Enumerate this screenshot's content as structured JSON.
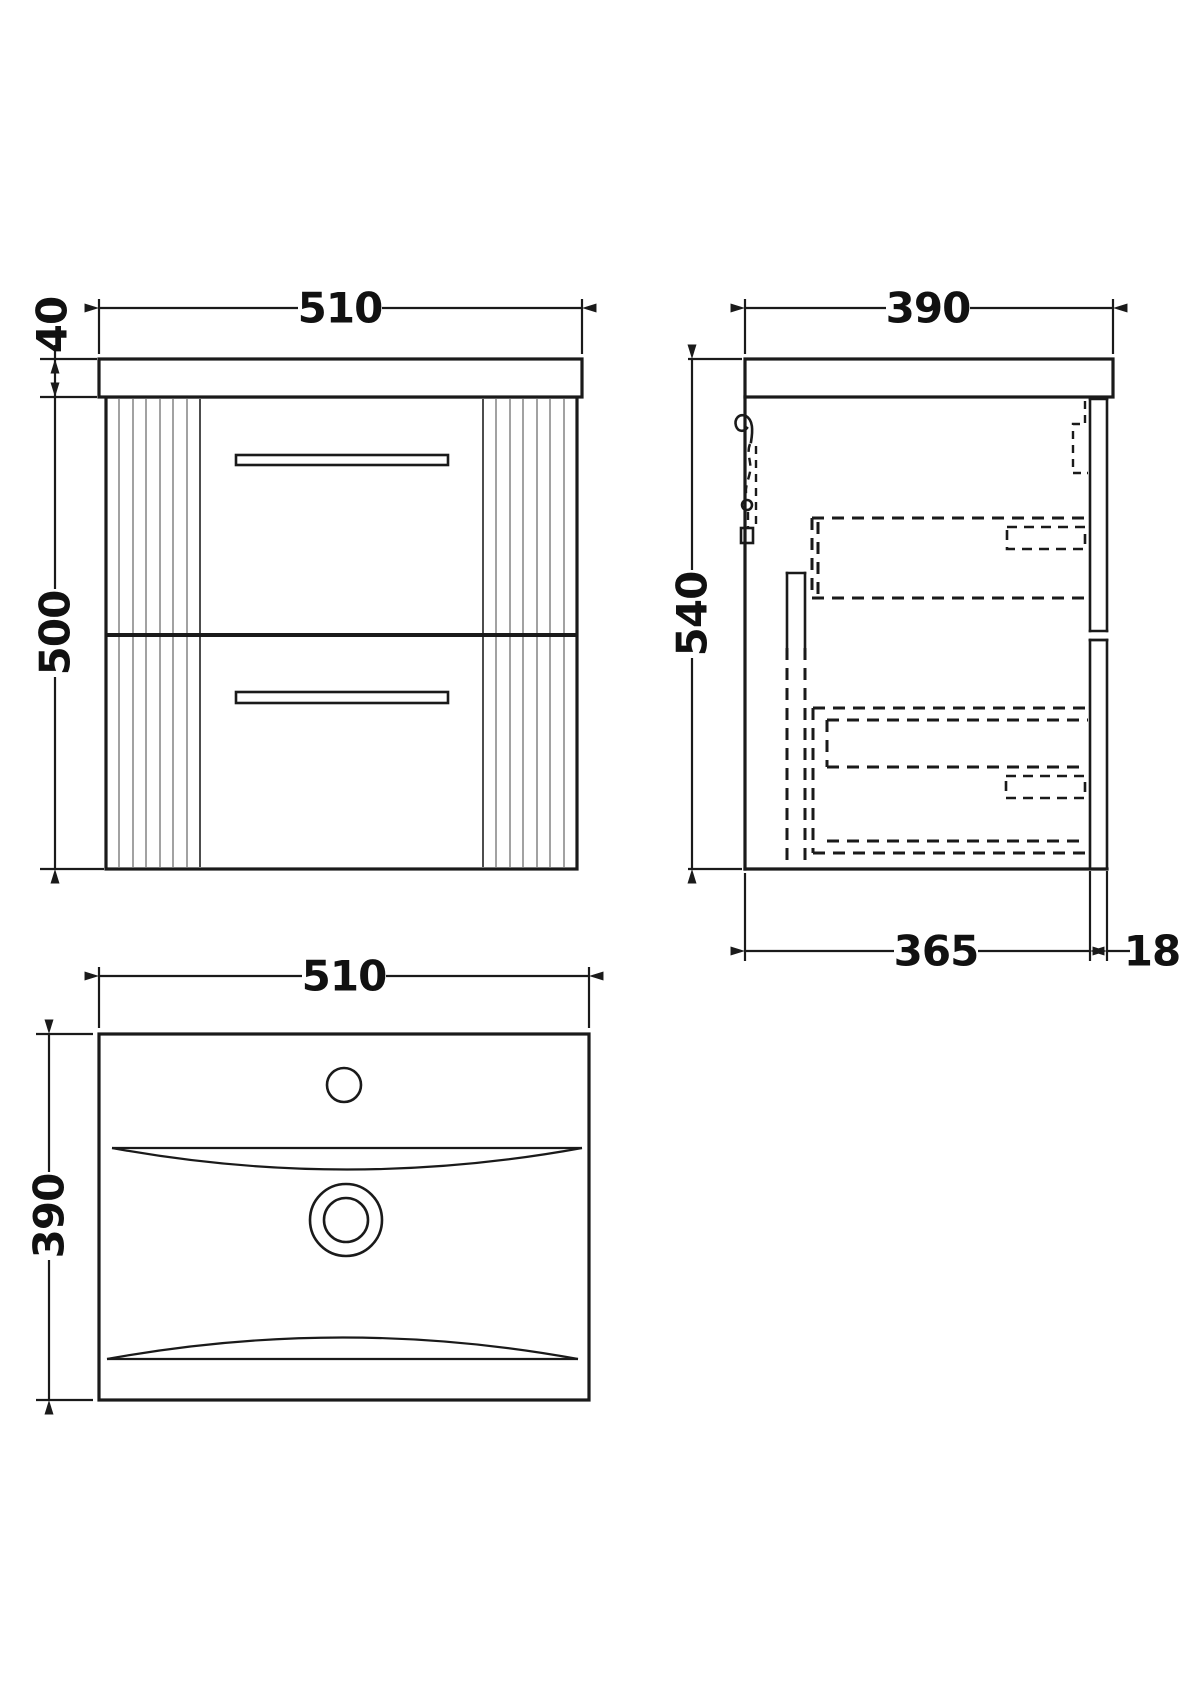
{
  "colors": {
    "line": "#1a1a1a",
    "flute": "#8a8a8a",
    "background": "#ffffff"
  },
  "views": {
    "front": {
      "dims": {
        "width": "510",
        "worktop_height": "40",
        "cabinet_height": "500"
      }
    },
    "side": {
      "dims": {
        "depth": "390",
        "height": "540",
        "carcass_depth": "365",
        "drawer_front_thickness": "18"
      }
    },
    "plan": {
      "dims": {
        "width": "510",
        "depth": "390"
      }
    }
  }
}
